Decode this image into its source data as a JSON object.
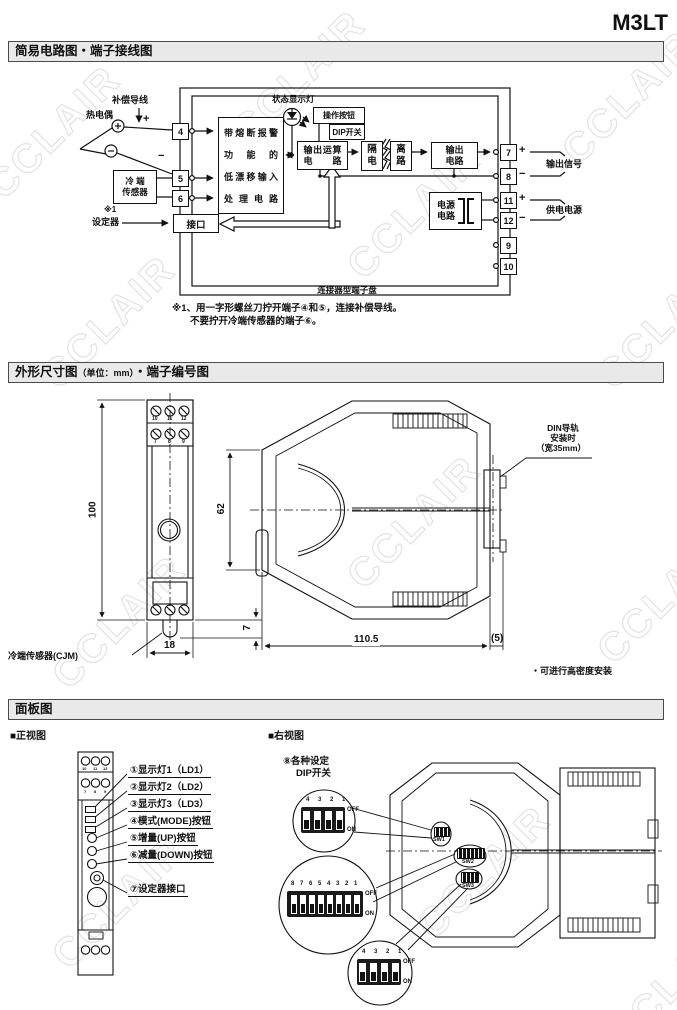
{
  "title": "M3LT",
  "watermark": "CCLAIR",
  "circuit": {
    "header": "简易电路图・端子接线图",
    "comp_wire": "补偿导线",
    "thermocouple": "热电偶",
    "plus": "+",
    "minus": "−",
    "cold_sensor_l1": "冷 端",
    "cold_sensor_l2": "传感器",
    "note_mark": "※1",
    "setter": "设定器",
    "interface": "接口",
    "input_l1": "带熔断报警",
    "input_l2": "功 能 的",
    "input_l3": "低漂移输入",
    "input_l4": "处理电路",
    "status_lamp": "状态显示灯",
    "op_button": "操作按钮",
    "dip_switch": "DIP开关",
    "calc_l1": "输出运算",
    "calc_l2": "电 路",
    "iso_l1": "隔",
    "iso_l2": "电",
    "iso_r1": "离",
    "iso_r2": "路",
    "out_l1": "输出",
    "out_l2": "电路",
    "psu_l1": "电源",
    "psu_l2": "电路",
    "terminal_board": "连接器型端子盘",
    "output_signal": "输出信号",
    "supply_power": "供电电源",
    "terminals_left": [
      "4",
      "5",
      "6"
    ],
    "terminals_right": [
      "7",
      "8",
      "11",
      "12",
      "9",
      "10"
    ],
    "note1": "※1、用一字形螺丝刀拧开端子④和⑤，连接补偿导线。",
    "note2": "不要拧开冷端传感器的端子⑥。"
  },
  "dims": {
    "header_main": "外形尺寸图",
    "header_unit": "（单位：mm）",
    "header_tail": "・端子编号图",
    "h100": "100",
    "w18": "18",
    "h7": "7",
    "d62": "62",
    "d110": "110.5",
    "d5": "(5)",
    "row1": [
      "10",
      "11",
      "12"
    ],
    "row2": [
      "7",
      "8",
      "9"
    ],
    "din_l1": "DIN导轨",
    "din_l2": "安装时",
    "din_l3": "（宽35mm）",
    "cjm": "冷端传感器(CJM)",
    "note": "・可进行高密度安装"
  },
  "panel": {
    "header": "面板图",
    "front_title": "■正视图",
    "right_title": "■右视图",
    "labels": [
      "①显示灯1（LD1）",
      "②显示灯2（LD2）",
      "③显示灯3（LD3）",
      "④模式(MODE)按钮",
      "⑤增量(UP)按钮",
      "⑥减量(DOWN)按钮"
    ],
    "setter_port": "⑦设定器接口",
    "dip_l1": "⑧各种设定",
    "dip_l2": "DIP开关",
    "nums4": "4 3 2 1",
    "nums8": "8 7 6 5 4 3 2 1",
    "off": "OFF",
    "on": "ON",
    "sw": [
      "SW1",
      "SW2",
      "SW3"
    ]
  }
}
